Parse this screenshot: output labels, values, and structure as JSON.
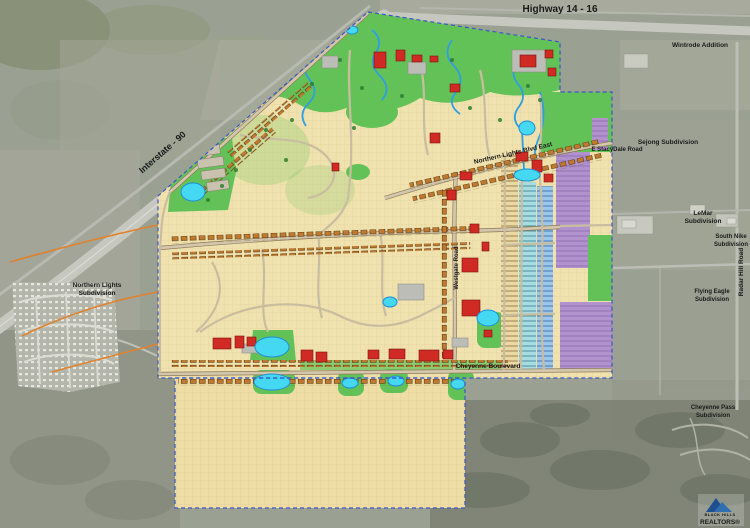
{
  "map": {
    "labels": {
      "highway": "Highway 14 - 16",
      "interstate": "Interstate - 90",
      "wintrode": "Wintrode Addition",
      "sejong": "Sejong Subdivision",
      "stacydale": "E StacyDale Road",
      "lemar_1": "LeMar",
      "lemar_2": "Subdivision",
      "south_nike_1": "South Nike",
      "south_nike_2": "Subdivision",
      "radar_hill": "Radar Hill Road",
      "flying_eagle_1": "Flying Eagle",
      "flying_eagle_2": "Subdivision",
      "cheyenne_pass_1": "Cheyenne Pass",
      "cheyenne_pass_2": "Subdivision",
      "northern_lights_1": "Northern Lights",
      "northern_lights_2": "Subdivision",
      "nl_blvd": "Northern Lights Blvd East",
      "westgate": "Westgate Road",
      "cheyenne_blvd": "Cheyenne Boulevard"
    },
    "logo": {
      "line1": "BLACK HILLS",
      "line2": "REALTORS®"
    },
    "colors": {
      "aerial_base": "#9aa092",
      "aerial_hills": "#7d8274",
      "plan_cream": "#f0e2ae",
      "park_green": "#63c257",
      "pond_cyan": "#45d8f2",
      "creek_blue": "#2f9fe0",
      "building_red": "#cf2b24",
      "house_orange": "#c07a30",
      "multifamily_purple": "#b292cc",
      "townhome_teal": "#a8dce0",
      "boundary_blue": "#3b57c8",
      "connector_orange": "#e0822e",
      "road_tan": "#d2c7ac",
      "logo_blue": "#1d4e89"
    }
  }
}
